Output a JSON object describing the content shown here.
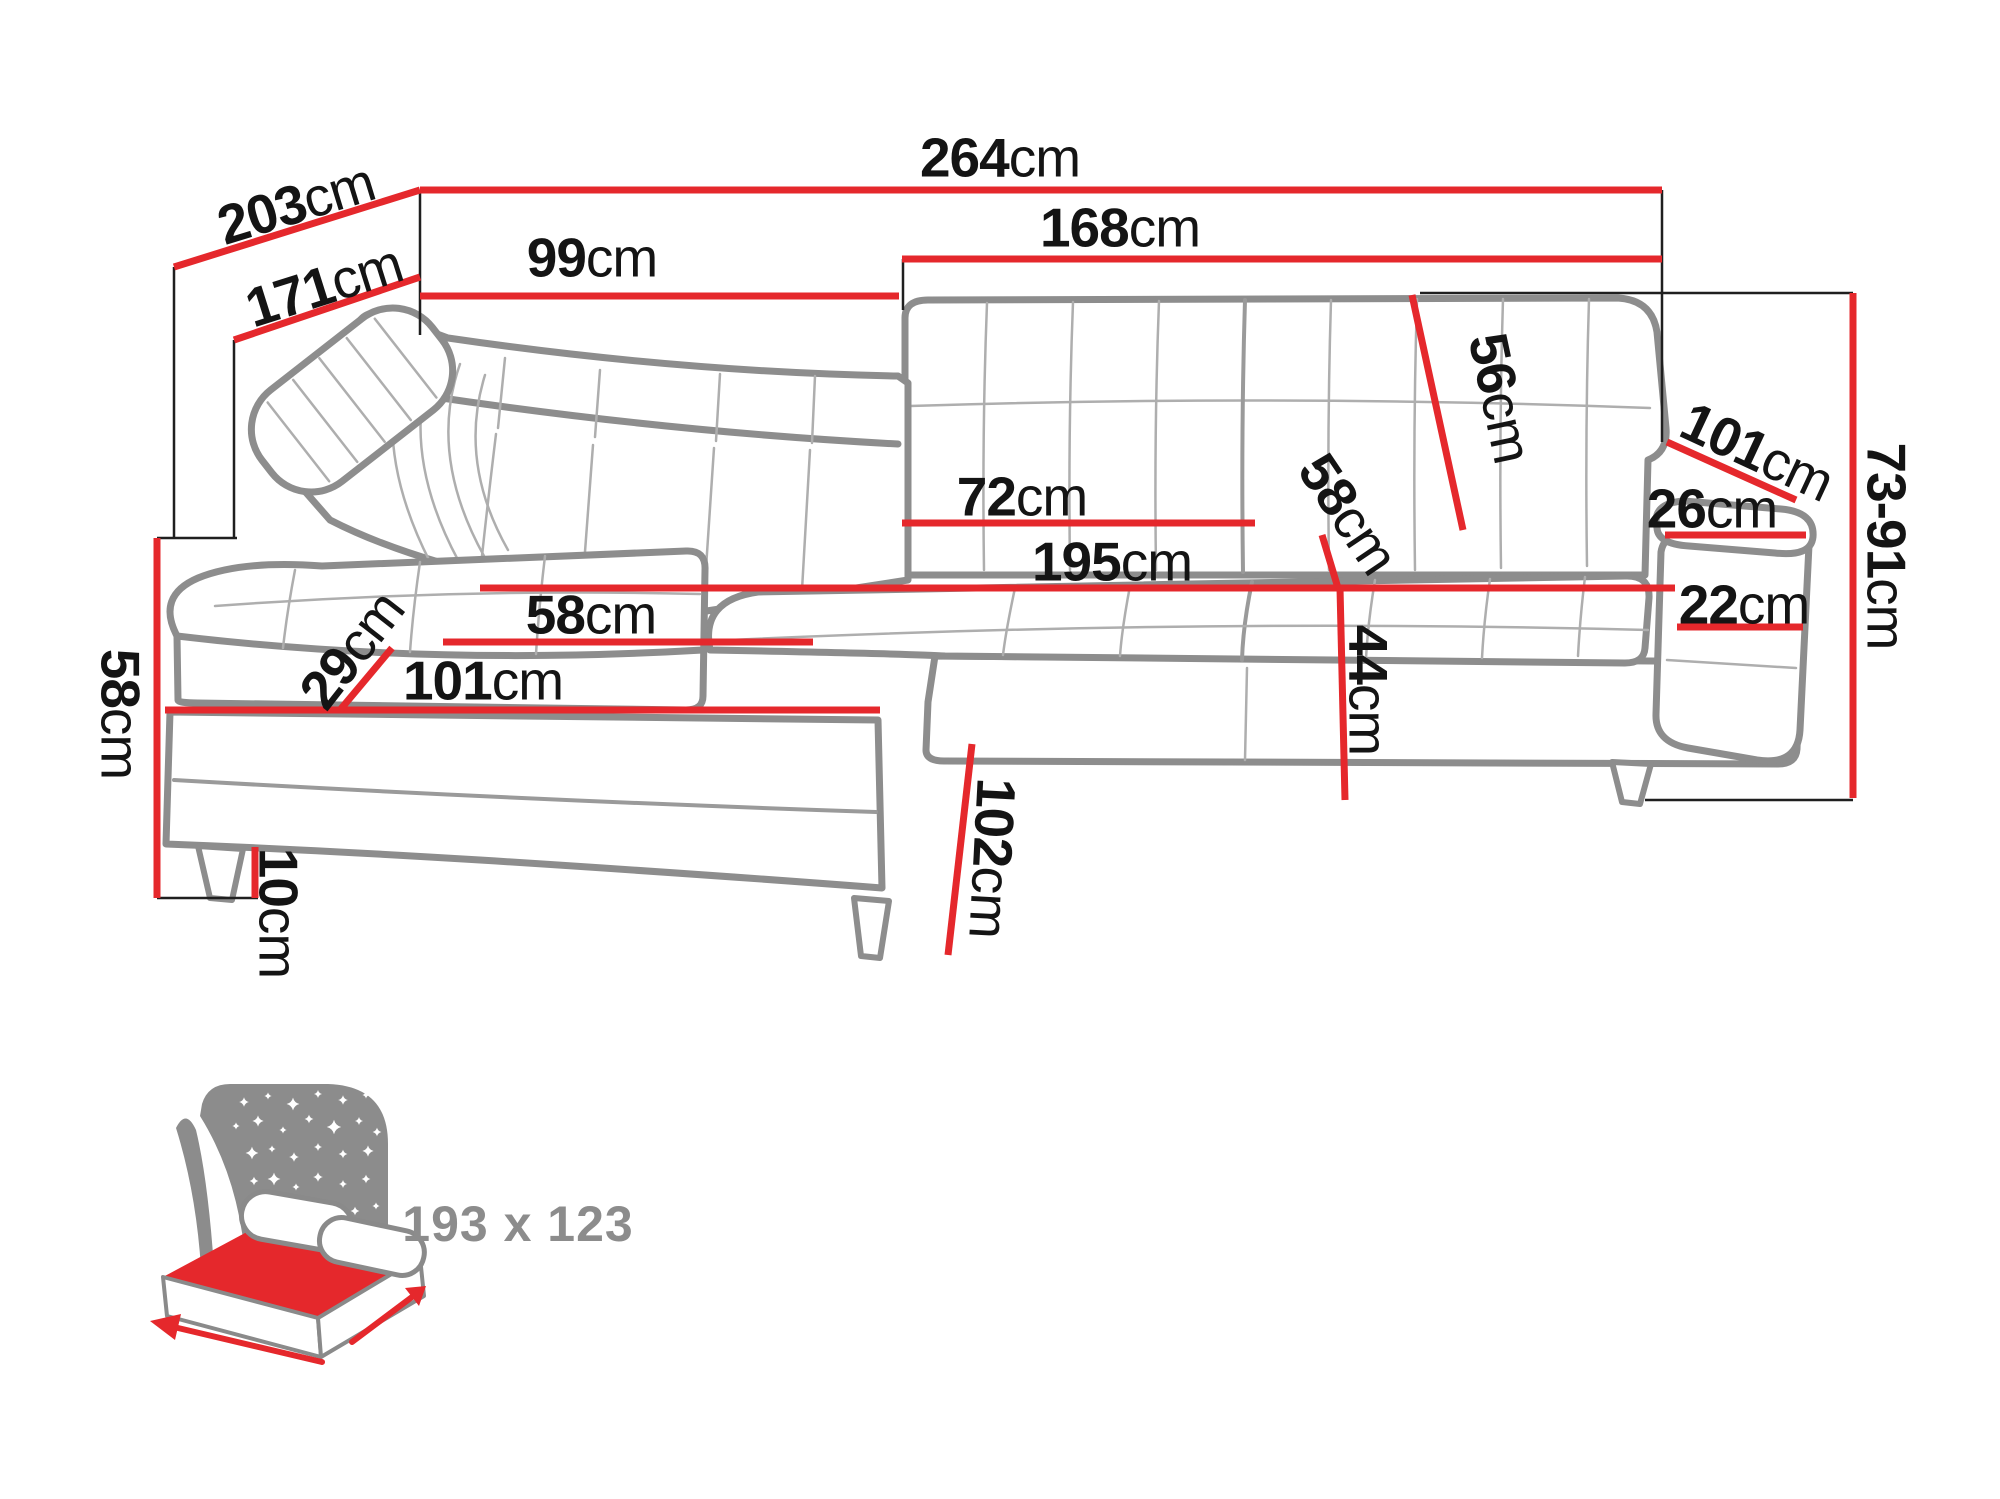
{
  "colors": {
    "dimension_line": "#e5282c",
    "label_text": "#141414",
    "sofa_outline": "#8d8d8d",
    "sofa_seam": "#aeaeae",
    "icon_gray": "#8c8c8c",
    "mattress_red": "#e5282c",
    "background": "#ffffff"
  },
  "sofa_diagram": {
    "dimensions": {
      "total_width": {
        "value": "264",
        "unit": "cm"
      },
      "total_depth": {
        "value": "203",
        "unit": "cm"
      },
      "inner_depth": {
        "value": "171",
        "unit": "cm"
      },
      "back_section_width": {
        "value": "99",
        "unit": "cm"
      },
      "right_section_width": {
        "value": "168",
        "unit": "cm"
      },
      "backrest_height": {
        "value": "56",
        "unit": "cm"
      },
      "armrest_length": {
        "value": "101",
        "unit": "cm"
      },
      "armrest_top_width": {
        "value": "26",
        "unit": "cm"
      },
      "armrest_front_width": {
        "value": "22",
        "unit": "cm"
      },
      "height_range": {
        "value": "73-91",
        "unit": "cm"
      },
      "seat_cushion_width": {
        "value": "72",
        "unit": "cm"
      },
      "seat_total_width": {
        "value": "195",
        "unit": "cm"
      },
      "seat_depth": {
        "value": "58",
        "unit": "cm"
      },
      "seat_height": {
        "value": "44",
        "unit": "cm"
      },
      "chaise_seat_width": {
        "value": "58",
        "unit": "cm"
      },
      "chaise_length": {
        "value": "101",
        "unit": "cm"
      },
      "seat_cushion_height": {
        "value": "29",
        "unit": "cm"
      },
      "side_height": {
        "value": "58",
        "unit": "cm"
      },
      "leg_height": {
        "value": "10",
        "unit": "cm"
      },
      "chaise_front_depth": {
        "value": "102",
        "unit": "cm"
      }
    },
    "sleeping_function": {
      "size_label": "193 x 123"
    }
  }
}
